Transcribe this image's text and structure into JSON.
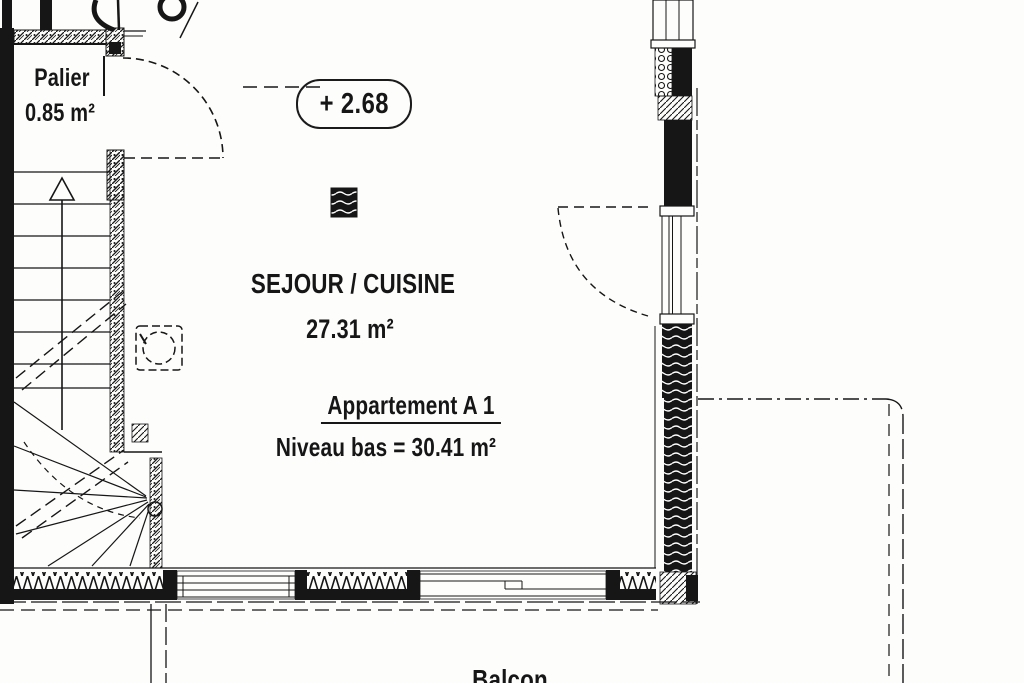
{
  "plan": {
    "landing": {
      "name": "Palier",
      "area": "0.85 m²"
    },
    "level_marker": "+ 2.68",
    "living_room": {
      "name": "SEJOUR / CUISINE",
      "area": "27.31 m²"
    },
    "apartment": {
      "name": "Appartement A 1",
      "lower_level_area": "Niveau bas = 30.41 m²"
    },
    "balcony": {
      "name": "Balcon"
    }
  },
  "colors": {
    "ink": "#161616",
    "paper": "#fdfdfc"
  }
}
